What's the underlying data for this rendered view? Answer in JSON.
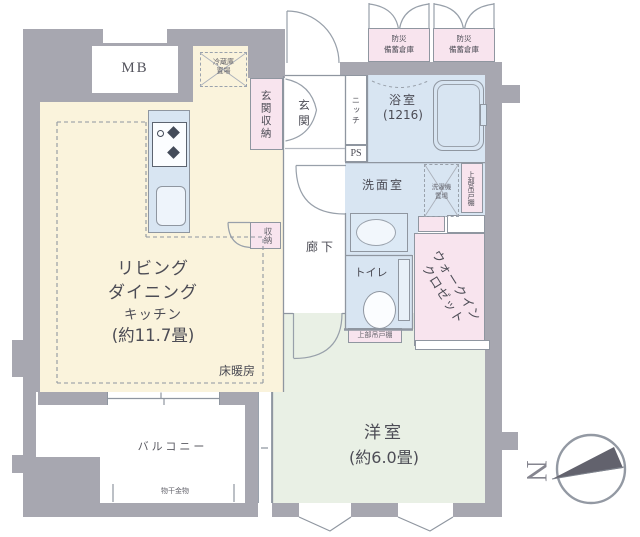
{
  "plan": {
    "mb": "MB",
    "fridge": [
      "冷蔵庫",
      "置場"
    ],
    "entrance_storage": "玄関収納",
    "entrance": "玄関",
    "niche": "ニッチ",
    "ps_upper": "PS",
    "ps_lower": "PS",
    "bathroom": [
      "浴室",
      "(1216)"
    ],
    "disaster_storage_1": [
      "防災",
      "備蓄倉庫"
    ],
    "disaster_storage_2": [
      "防災",
      "備蓄倉庫"
    ],
    "washroom": "洗面室",
    "washer": [
      "洗濯機",
      "置場"
    ],
    "upper_cabinet_wash": "上部吊戸棚",
    "upper_cabinet_toilet": "上部吊戸棚",
    "corridor": "廊下",
    "toilet": "トイレ",
    "wic": [
      "ウォークイン",
      "クロゼット"
    ],
    "closet": "収納",
    "ldk": [
      "リビング",
      "ダイニング",
      "キッチン",
      "(約11.7畳)"
    ],
    "floor_heating": "床暖房",
    "bedroom": [
      "洋室",
      "(約6.0畳)"
    ],
    "balcony": "バルコニー",
    "drying_fixture": "物干金物",
    "compass_letter": "N"
  },
  "colors": {
    "wall": "#a7a7b0",
    "water_blue": "#d8e5f2",
    "ldk_cream": "#faf3dc",
    "closet_pink": "#f8e4ee",
    "bedroom_green": "#e9f0e5",
    "line": "#8f96a0",
    "text": "#4c4c55"
  }
}
